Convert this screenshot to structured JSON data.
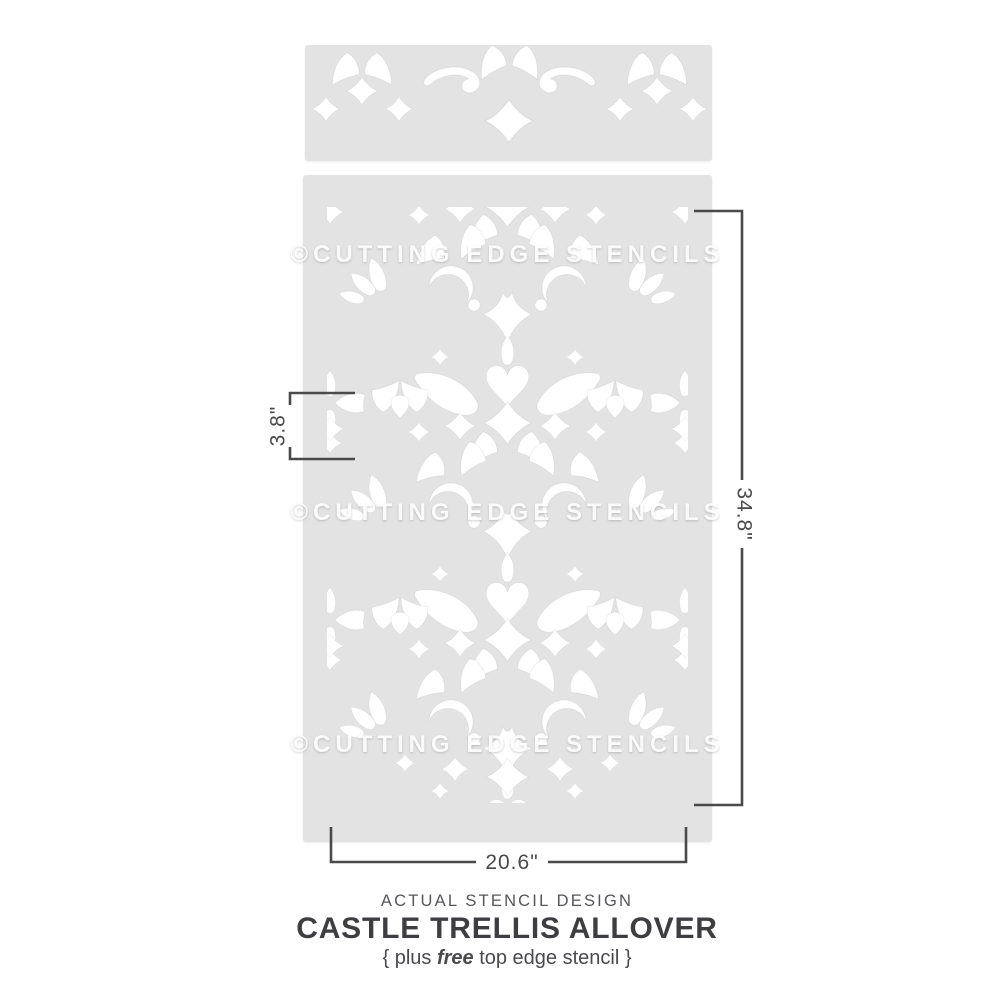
{
  "stencil": {
    "watermark": "©CUTTING EDGE STENCILS",
    "panel_count": 2,
    "top_strip_name": "top edge stencil",
    "main_panel_name": "allover stencil"
  },
  "dimensions": {
    "repeat_height_label": "3.8\"",
    "height_label": "34.8\"",
    "width_label": "20.6\""
  },
  "caption": {
    "eyebrow": "ACTUAL STENCIL DESIGN",
    "title": "CASTLE TRELLIS ALLOVER",
    "subtitle_prefix": "{ plus ",
    "subtitle_emphasis": "free",
    "subtitle_suffix": " top edge stencil }"
  },
  "colors": {
    "background": "#ffffff",
    "panel": "#e3e3e4",
    "cutout": "#ffffff",
    "dimension_lines": "#4a4a4a",
    "title_text": "#3e3e42",
    "watermark": "#ffffff"
  }
}
